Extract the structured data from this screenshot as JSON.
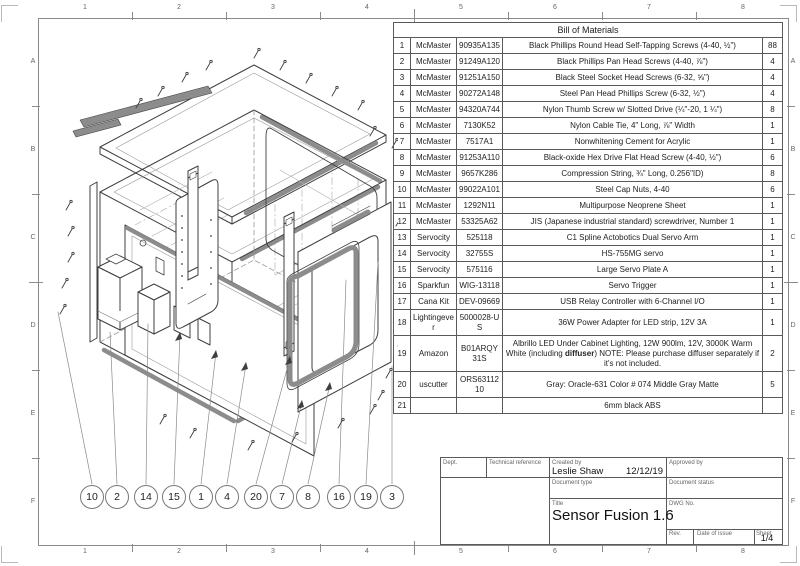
{
  "sheet": {
    "zones_horizontal": [
      "1",
      "2",
      "3",
      "4",
      "5",
      "6",
      "7",
      "8"
    ],
    "zones_vertical": [
      "A",
      "B",
      "C",
      "D",
      "E",
      "F"
    ]
  },
  "bom": {
    "title": "Bill of Materials",
    "rows": [
      {
        "no": "1",
        "supplier": "McMaster",
        "part": "90935A135",
        "desc": "Black Phillips Round Head Self-Tapping Screws (4-40, ½\")",
        "qty": "88"
      },
      {
        "no": "2",
        "supplier": "McMaster",
        "part": "91249A120",
        "desc": "Black Phillips Pan Head Screws (4-40, ⅞\")",
        "qty": "4"
      },
      {
        "no": "3",
        "supplier": "McMaster",
        "part": "91251A150",
        "desc": "Black Steel Socket Head Screws (6-32, ⅝\")",
        "qty": "4"
      },
      {
        "no": "4",
        "supplier": "McMaster",
        "part": "90272A148",
        "desc": "Steel Pan Head Phillips Screw (6-32, ½\")",
        "qty": "4"
      },
      {
        "no": "5",
        "supplier": "McMaster",
        "part": "94320A744",
        "desc": "Nylon Thumb Screw w/ Slotted Drive (¼\"-20, 1 ¼\")",
        "qty": "8"
      },
      {
        "no": "6",
        "supplier": "McMaster",
        "part": "7130K52",
        "desc": "Nylon Cable Tie, 4\" Long, ⅞\" Width",
        "qty": "1"
      },
      {
        "no": "7",
        "supplier": "McMaster",
        "part": "7517A1",
        "desc": "Nonwhitening Cement for Acrylic",
        "qty": "1"
      },
      {
        "no": "8",
        "supplier": "McMaster",
        "part": "91253A110",
        "desc": "Black-oxide Hex Drive Flat Head Screw (4-40, ½\")",
        "qty": "6"
      },
      {
        "no": "9",
        "supplier": "McMaster",
        "part": "9657K286",
        "desc": "Compression String, ¾\" Long, 0.256\"ID)",
        "qty": "8"
      },
      {
        "no": "10",
        "supplier": "McMaster",
        "part": "99022A101",
        "desc": "Steel Cap Nuts, 4-40",
        "qty": "6"
      },
      {
        "no": "11",
        "supplier": "McMaster",
        "part": "1292N11",
        "desc": "Multipurpose Neoprene Sheet",
        "qty": "1"
      },
      {
        "no": "12",
        "supplier": "McMaster",
        "part": "53325A62",
        "desc": "JIS (Japanese industrial standard) screwdriver, Number 1",
        "qty": "1"
      },
      {
        "no": "13",
        "supplier": "Servocity",
        "part": "525118",
        "desc": "C1 Spline Actobotics Dual Servo Arm",
        "qty": "1"
      },
      {
        "no": "14",
        "supplier": "Servocity",
        "part": "32755S",
        "desc": "HS-755MG servo",
        "qty": "1"
      },
      {
        "no": "15",
        "supplier": "Servocity",
        "part": "575116",
        "desc": "Large Servo Plate A",
        "qty": "1"
      },
      {
        "no": "16",
        "supplier": "Sparkfun",
        "part": "WIG-13118",
        "desc": "Servo Trigger",
        "qty": "1"
      },
      {
        "no": "17",
        "supplier": "Cana Kit",
        "part": "DEV-09669",
        "desc": "USB Relay Controller with 6-Channel I/O",
        "qty": "1"
      },
      {
        "no": "18",
        "supplier": "Lightingever",
        "part": "5000028-US",
        "desc": "36W Power Adapter for LED strip, 12V 3A",
        "qty": "1"
      },
      {
        "no": "19",
        "supplier": "Amazon",
        "part": "B01ARQY31S",
        "desc_parts": [
          {
            "text": "Albrillo LED Under Cabinet Lighting, 12W 900lm, 12V, 3000K Warm White (including "
          },
          {
            "text": "diffuser",
            "bold": true
          },
          {
            "text": ") NOTE: Please purchase diffuser separately if it's not included."
          }
        ],
        "qty": "2"
      },
      {
        "no": "20",
        "supplier": "uscutter",
        "part": "ORS6311210",
        "desc": "Gray: Oracle-631 Color # 074 Middle Gray Matte",
        "qty": "5"
      },
      {
        "no": "21",
        "supplier": "",
        "part": "",
        "desc": "6mm black ABS",
        "qty": ""
      }
    ]
  },
  "balloons": [
    "10",
    "2",
    "14",
    "15",
    "1",
    "4",
    "20",
    "7",
    "8",
    "16",
    "19",
    "3"
  ],
  "title_block": {
    "dept_label": "Dept.",
    "tech_ref_label": "Technical reference",
    "created_by_label": "Created by",
    "created_by": "Leslie Shaw",
    "created_date": "12/12/19",
    "approved_by_label": "Approved by",
    "doc_type_label": "Document type",
    "doc_status_label": "Document status",
    "title_label": "Title",
    "title": "Sensor Fusion 1.6",
    "dwg_no_label": "DWG No.",
    "rev_label": "Rev.",
    "date_of_issue_label": "Date of issue",
    "sheet_label": "Sheet",
    "sheet": "1/4"
  },
  "colors": {
    "line": "#3f3f3f",
    "frame": "#8a8a8a",
    "strip_gray": "#8c8c8c",
    "table_border": "#5a5a5a"
  }
}
